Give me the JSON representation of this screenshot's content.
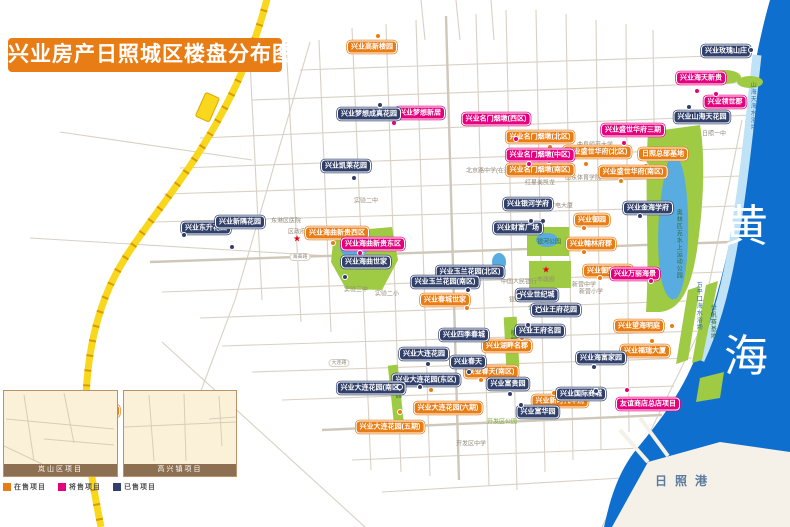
{
  "title": "兴业房产日照城区楼盘分布图",
  "colors": {
    "onsale": "#e87c15",
    "presale": "#e5007e",
    "sold": "#31406b",
    "sea": "#0e6fcf",
    "park": "#9fca44",
    "highway": "#f8d71c",
    "inset_bar": "#8d6f52"
  },
  "legend": {
    "items": [
      {
        "label": "在售项目",
        "type": "onsale"
      },
      {
        "label": "将售项目",
        "type": "presale"
      },
      {
        "label": "已售项目",
        "type": "sold"
      }
    ]
  },
  "sea": {
    "name": "黄海",
    "chars": [
      "黄",
      "海"
    ],
    "port_label": "日照港"
  },
  "markers": [
    {
      "text": "兴业高新楼园",
      "type": "onsale",
      "x": 372,
      "y": 47,
      "dx": 378,
      "dy": 36
    },
    {
      "text": "兴业名门烟墩(北区)",
      "type": "onsale",
      "x": 540,
      "y": 137,
      "dx": 550,
      "dy": 147
    },
    {
      "text": "兴业名门烟墩(南区)",
      "type": "onsale",
      "x": 540,
      "y": 170,
      "dx": 549,
      "dy": 161
    },
    {
      "text": "兴业盛世华府(北区)",
      "type": "onsale",
      "x": 597,
      "y": 152,
      "dx": 586,
      "dy": 164
    },
    {
      "text": "日照总部基地",
      "type": "onsale",
      "x": 663,
      "y": 154,
      "dx": 646,
      "dy": 166
    },
    {
      "text": "兴业盛世华府(南区)",
      "type": "onsale",
      "x": 633,
      "y": 172,
      "dx": 621,
      "dy": 181
    },
    {
      "text": "兴业海曲新贵西区",
      "type": "onsale",
      "x": 337,
      "y": 233,
      "dx": 333,
      "dy": 243
    },
    {
      "text": "兴业春城世家",
      "type": "onsale",
      "x": 445,
      "y": 300,
      "dx": 467,
      "dy": 308
    },
    {
      "text": "兴业御园",
      "type": "onsale",
      "x": 592,
      "y": 220,
      "dx": 584,
      "dy": 228
    },
    {
      "text": "兴业翰林府郡",
      "type": "onsale",
      "x": 591,
      "y": 244,
      "dx": 584,
      "dy": 252
    },
    {
      "text": "兴业御墅学府",
      "type": "onsale",
      "x": 608,
      "y": 271,
      "dx": 600,
      "dy": 278
    },
    {
      "text": "兴业望海明庭",
      "type": "onsale",
      "x": 639,
      "y": 326,
      "dx": 672,
      "dy": 326
    },
    {
      "text": "兴业福瑞大厦",
      "type": "onsale",
      "x": 645,
      "y": 351,
      "dx": 652,
      "dy": 341
    },
    {
      "text": "兴业湖畔名郡",
      "type": "onsale",
      "x": 507,
      "y": 346,
      "dx": 522,
      "dy": 338
    },
    {
      "text": "兴业春天(南区)",
      "type": "onsale",
      "x": 491,
      "y": 372,
      "dx": 481,
      "dy": 380
    },
    {
      "text": "兴业新时代华府",
      "type": "onsale",
      "x": 560,
      "y": 401,
      "dx": 554,
      "dy": 393
    },
    {
      "text": "兴业大连花园(六期)",
      "type": "onsale",
      "x": 448,
      "y": 408,
      "dx": 431,
      "dy": 390
    },
    {
      "text": "兴业大连花园(五期)",
      "type": "onsale",
      "x": 390,
      "y": 427,
      "dx": 400,
      "dy": 412
    },
    {
      "text": "兴业望澜嘉园",
      "type": "onsale",
      "x": 95,
      "y": 411,
      "dx": 89,
      "dy": 422
    },
    {
      "text": "兴业梦想新居",
      "type": "presale",
      "x": 420,
      "y": 113,
      "dx": 394,
      "dy": 123
    },
    {
      "text": "兴业名门烟墩(西区)",
      "type": "presale",
      "x": 496,
      "y": 119,
      "dx": 516,
      "dy": 139
    },
    {
      "text": "兴业名门烟墩(中区)",
      "type": "presale",
      "x": 540,
      "y": 155,
      "dx": 529,
      "dy": 164
    },
    {
      "text": "兴业盛世华府三期",
      "type": "presale",
      "x": 633,
      "y": 130,
      "dx": 624,
      "dy": 143
    },
    {
      "text": "兴业海天新贵",
      "type": "presale",
      "x": 701,
      "y": 78,
      "dx": 697,
      "dy": 91
    },
    {
      "text": "兴业领世郡",
      "type": "presale",
      "x": 725,
      "y": 102,
      "dx": 716,
      "dy": 94
    },
    {
      "text": "兴业海曲新贵东区",
      "type": "presale",
      "x": 373,
      "y": 244,
      "dx": 360,
      "dy": 253
    },
    {
      "text": "兴业万丽海景",
      "type": "presale",
      "x": 635,
      "y": 274,
      "dx": 651,
      "dy": 281
    },
    {
      "text": "友谊商店总店项目",
      "type": "presale",
      "x": 648,
      "y": 404,
      "dx": 627,
      "dy": 390
    },
    {
      "text": "兴业金海花园(二期)",
      "type": "presale",
      "x": 195,
      "y": 419,
      "dx": 187,
      "dy": 428
    },
    {
      "text": "兴业梦想成真花园",
      "type": "sold",
      "x": 369,
      "y": 114,
      "dx": 380,
      "dy": 105
    },
    {
      "text": "兴业凯莱花园",
      "type": "sold",
      "x": 346,
      "y": 166,
      "dx": 354,
      "dy": 178
    },
    {
      "text": "兴业玫瑰山庄",
      "type": "sold",
      "x": 726,
      "y": 51,
      "dx": 751,
      "dy": 50
    },
    {
      "text": "兴业山海天花园",
      "type": "sold",
      "x": 702,
      "y": 117,
      "dx": 689,
      "dy": 107
    },
    {
      "text": "兴业东升花园",
      "type": "sold",
      "x": 206,
      "y": 228,
      "dx": 184,
      "dy": 235
    },
    {
      "text": "兴业新隅花园",
      "type": "sold",
      "x": 240,
      "y": 222,
      "dx": 232,
      "dy": 247
    },
    {
      "text": "兴业海曲世家",
      "type": "sold",
      "x": 366,
      "y": 262,
      "dx": 345,
      "dy": 277
    },
    {
      "text": "兴业银河学府",
      "type": "sold",
      "x": 528,
      "y": 204,
      "dx": 543,
      "dy": 221
    },
    {
      "text": "兴业财富广场",
      "type": "sold",
      "x": 518,
      "y": 228,
      "dx": 531,
      "dy": 221
    },
    {
      "text": "兴业玉兰花园(北区)",
      "type": "sold",
      "x": 470,
      "y": 272,
      "dx": 461,
      "dy": 281
    },
    {
      "text": "兴业玉兰花园(南区)",
      "type": "sold",
      "x": 445,
      "y": 282,
      "dx": 468,
      "dy": 290
    },
    {
      "text": "兴业金海学府",
      "type": "sold",
      "x": 648,
      "y": 208,
      "dx": 640,
      "dy": 216
    },
    {
      "text": "兴业世纪城",
      "type": "sold",
      "x": 537,
      "y": 295,
      "dx": 519,
      "dy": 296
    },
    {
      "text": "兴业王府花园",
      "type": "sold",
      "x": 556,
      "y": 310,
      "dx": 539,
      "dy": 310
    },
    {
      "text": "兴业王府名园",
      "type": "sold",
      "x": 540,
      "y": 331,
      "dx": 528,
      "dy": 325
    },
    {
      "text": "兴业四季春城",
      "type": "sold",
      "x": 464,
      "y": 335
    },
    {
      "text": "兴业大连花园",
      "type": "sold",
      "x": 424,
      "y": 354,
      "dx": 428,
      "dy": 364
    },
    {
      "text": "兴业春天",
      "type": "sold",
      "x": 468,
      "y": 362,
      "dx": 469,
      "dy": 372
    },
    {
      "text": "兴业大连花园(东区)",
      "type": "sold",
      "x": 426,
      "y": 380,
      "dx": 420,
      "dy": 387
    },
    {
      "text": "兴业富贵园",
      "type": "sold",
      "x": 508,
      "y": 384,
      "dx": 510,
      "dy": 394
    },
    {
      "text": "兴业大连花园(南区)",
      "type": "sold",
      "x": 371,
      "y": 388,
      "dx": 400,
      "dy": 387
    },
    {
      "text": "兴业富华园",
      "type": "sold",
      "x": 538,
      "y": 412,
      "dx": 521,
      "dy": 405
    },
    {
      "text": "兴业海富家园",
      "type": "sold",
      "x": 601,
      "y": 358,
      "dx": 594,
      "dy": 367
    },
    {
      "text": "兴业国际商城",
      "type": "sold",
      "x": 581,
      "y": 394,
      "dx": 596,
      "dy": 391
    }
  ],
  "pois": [
    {
      "text": "市政府",
      "x": 546,
      "y": 279,
      "star": [
        546,
        270
      ]
    },
    {
      "text": "区政府",
      "x": 297,
      "y": 231,
      "star": [
        297,
        239
      ]
    },
    {
      "text": "岚山区政府",
      "x": 28,
      "y": 404,
      "star": [
        13,
        397
      ]
    },
    {
      "text": "实验二中",
      "x": 366,
      "y": 200
    },
    {
      "text": "北京路中学(在建)",
      "x": 489,
      "y": 170
    },
    {
      "text": "曲阜师范大学",
      "x": 595,
      "y": 144
    },
    {
      "text": "山东体育学院",
      "x": 583,
      "y": 177
    },
    {
      "text": "红星美凯龙",
      "x": 540,
      "y": 182
    },
    {
      "text": "日照一中",
      "x": 714,
      "y": 133
    },
    {
      "text": "广电大厦",
      "x": 561,
      "y": 205
    },
    {
      "text": "东港区医院",
      "x": 286,
      "y": 220
    },
    {
      "text": "实验三中",
      "x": 356,
      "y": 289
    },
    {
      "text": "实验二小",
      "x": 387,
      "y": 293
    },
    {
      "text": "中国人民银行",
      "x": 519,
      "y": 281
    },
    {
      "text": "银座商城",
      "x": 521,
      "y": 299
    },
    {
      "text": "新营中学",
      "x": 584,
      "y": 284
    },
    {
      "text": "新营小学",
      "x": 591,
      "y": 291
    },
    {
      "text": "金海岸小学",
      "x": 543,
      "y": 307
    },
    {
      "text": "开发区中学",
      "x": 471,
      "y": 443
    }
  ],
  "park_labels": [
    {
      "text": "海曲公园",
      "x": 360,
      "y": 256,
      "style": "white-v"
    },
    {
      "text": "银河公园",
      "x": 549,
      "y": 243,
      "style": "dark"
    },
    {
      "text": "奥林匹克水上运动公园",
      "x": 678,
      "y": 244,
      "style": "dark-v"
    },
    {
      "text": "世帆赛基地",
      "x": 712,
      "y": 322,
      "style": "dark-v"
    },
    {
      "text": "万平口海水浴场",
      "x": 698,
      "y": 306,
      "style": "blue-v"
    },
    {
      "text": "山海天海水浴场",
      "x": 752,
      "y": 106,
      "style": "blue-v"
    },
    {
      "text": "植物园",
      "x": 512,
      "y": 340,
      "style": "dark-v"
    },
    {
      "text": "公园",
      "x": 397,
      "y": 392,
      "style": "dark-v"
    },
    {
      "text": "开发区公园",
      "x": 502,
      "y": 423,
      "style": "green"
    }
  ],
  "road_labels": [
    {
      "text": "天津路",
      "x": 402,
      "y": 427
    },
    {
      "text": "大连路",
      "x": 339,
      "y": 363
    },
    {
      "text": "海曲路",
      "x": 300,
      "y": 257
    }
  ],
  "insets": [
    {
      "title": "岚山区项目"
    },
    {
      "title": "高兴镇项目"
    }
  ]
}
